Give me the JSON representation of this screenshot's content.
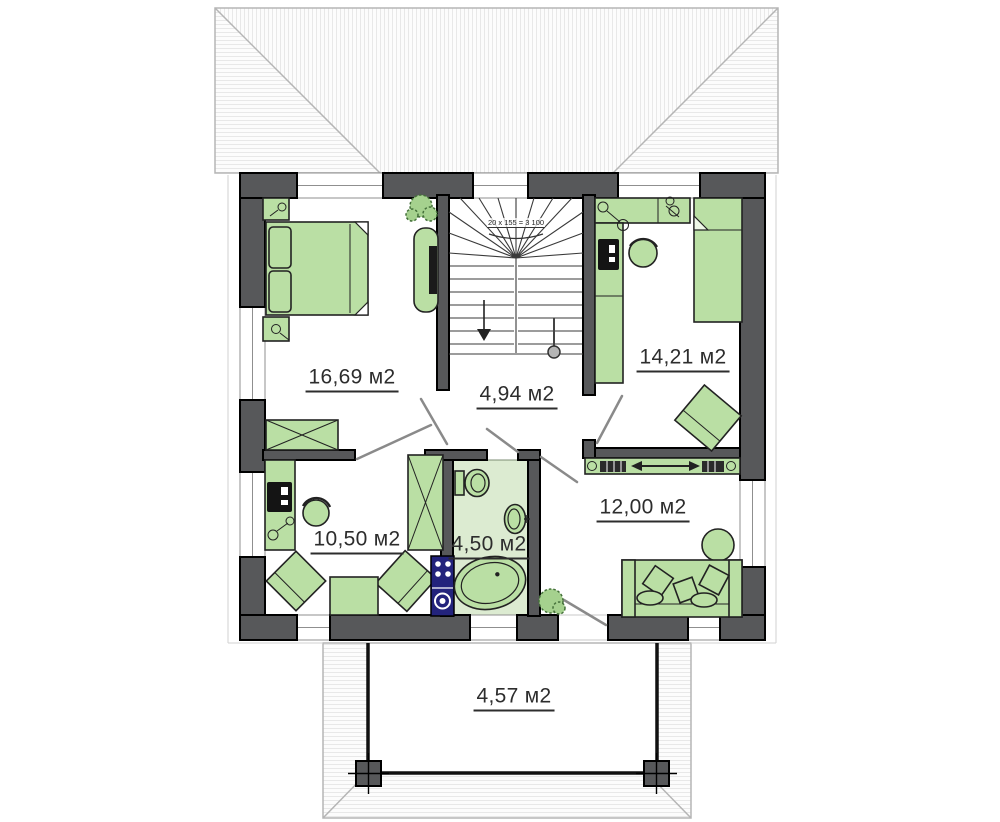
{
  "plan": {
    "title": "second-floor-plan",
    "rooms": [
      {
        "id": "bedroom-top-left",
        "area_label": "16,69 м2"
      },
      {
        "id": "stair-hall",
        "area_label": "4,94 м2"
      },
      {
        "id": "bedroom-top-right",
        "area_label": "14,21 м2"
      },
      {
        "id": "room-bottom-left",
        "area_label": "10,50 м2"
      },
      {
        "id": "bathroom",
        "area_label": "4,50 м2"
      },
      {
        "id": "room-bottom-right",
        "area_label": "12,00 м2"
      },
      {
        "id": "balcony",
        "area_label": "4,57 м2"
      }
    ],
    "stair_note": "20 x 155 = 3 100",
    "furniture_legend": [
      "bed",
      "nightstand",
      "wardrobe",
      "desk",
      "monitor",
      "chair",
      "armchair",
      "table",
      "sofa",
      "pouf",
      "sliding-wardrobe",
      "washer",
      "toilet",
      "sink",
      "bathtub",
      "plant",
      "tv"
    ],
    "colors": {
      "wall": "#57585a",
      "furniture": "#badfa4",
      "furniture_stroke": "#222222",
      "bathroom_floor": "#dcebd1",
      "appliance": "#23237c",
      "hatch": "#e8e8e8",
      "label_text": "#2d2d2d"
    }
  }
}
